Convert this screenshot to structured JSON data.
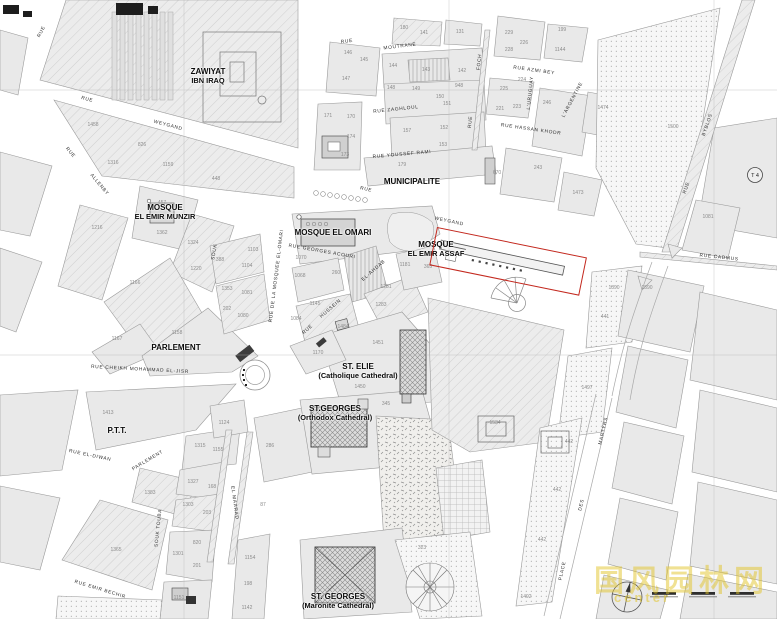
{
  "map": {
    "highlight_color": "#c3281e",
    "t4_label": "T 4",
    "watermark": {
      "line1": "国风园林网",
      "line2": "center"
    },
    "landmarks": [
      {
        "line1": "ZAWIYAT",
        "line2": "IBN IRAQ",
        "x": 208,
        "y": 76
      },
      {
        "line1": "MOSQUE",
        "line2": "EL EMIR MUNZIR",
        "x": 165,
        "y": 212
      },
      {
        "line1": "MOSQUE EL OMARI",
        "x": 333,
        "y": 233
      },
      {
        "line1": "MUNICIPALITE",
        "x": 412,
        "y": 182
      },
      {
        "line1": "MOSQUE",
        "line2": "EL EMIR ASSAF",
        "x": 436,
        "y": 249
      },
      {
        "line1": "PARLEMENT",
        "x": 176,
        "y": 348
      },
      {
        "line1": "ST. ELIE",
        "line2": "(Catholique Cathedral)",
        "x": 358,
        "y": 371
      },
      {
        "line1": "ST.GEORGES",
        "line2": "(Orthodox Cathedral)",
        "x": 335,
        "y": 413
      },
      {
        "line1": "P.T.T.",
        "x": 117,
        "y": 431
      },
      {
        "line1": "ST. GEORGES",
        "line2": "(Maronite Cathedral)",
        "x": 338,
        "y": 601
      }
    ],
    "streets": [
      {
        "t": "RUE",
        "x": 42,
        "y": 32,
        "r": -62
      },
      {
        "t": "RUE",
        "x": 87,
        "y": 100,
        "r": 15
      },
      {
        "t": "WEYGAND",
        "x": 168,
        "y": 126,
        "r": 15
      },
      {
        "t": "RUE",
        "x": 366,
        "y": 190,
        "r": 13
      },
      {
        "t": "WEYGAND",
        "x": 449,
        "y": 222,
        "r": 12
      },
      {
        "t": "RUE",
        "x": 70,
        "y": 153,
        "r": 50
      },
      {
        "t": "ALLENBY",
        "x": 99,
        "y": 185,
        "r": 50
      },
      {
        "t": "RUE",
        "x": 347,
        "y": 42,
        "r": -7
      },
      {
        "t": "MOUTRANE",
        "x": 400,
        "y": 47,
        "r": -7
      },
      {
        "t": "RUE ZAGHLOUL",
        "x": 396,
        "y": 110,
        "r": -6
      },
      {
        "t": "RUE YOUSSEF RAMI",
        "x": 402,
        "y": 155,
        "r": -5
      },
      {
        "t": "FOCH",
        "x": 480,
        "y": 62,
        "r": -84
      },
      {
        "t": "RUE",
        "x": 471,
        "y": 122,
        "r": -84
      },
      {
        "t": "RUE AZMI BEY",
        "x": 534,
        "y": 71,
        "r": 8
      },
      {
        "t": "L'URUGUAY",
        "x": 531,
        "y": 93,
        "r": -84
      },
      {
        "t": "L'ARGENTINE",
        "x": 573,
        "y": 100,
        "r": -62
      },
      {
        "t": "RUE HASSAN KHODR",
        "x": 531,
        "y": 130,
        "r": 8
      },
      {
        "t": "BYBLOS",
        "x": 708,
        "y": 125,
        "r": -71
      },
      {
        "t": "RUE",
        "x": 687,
        "y": 188,
        "r": -71
      },
      {
        "t": "RUE CADMUS",
        "x": 719,
        "y": 258,
        "r": 6
      },
      {
        "t": "RUE GEORGES ACOURI",
        "x": 322,
        "y": 252,
        "r": 10
      },
      {
        "t": "RUE DE LA MOSQUEE EL-OMARI",
        "x": 277,
        "y": 276,
        "r": -83
      },
      {
        "t": "EL-AHDAB",
        "x": 374,
        "y": 271,
        "r": -41
      },
      {
        "t": "HUSSEIN",
        "x": 331,
        "y": 309,
        "r": -41
      },
      {
        "t": "RUE",
        "x": 308,
        "y": 330,
        "r": -41
      },
      {
        "t": "SOUK",
        "x": 215,
        "y": 252,
        "r": -80
      },
      {
        "t": "RUE CHEIKH MOHAMMAD EL-JISR",
        "x": 140,
        "y": 370,
        "r": 3
      },
      {
        "t": "PARLEMENT",
        "x": 148,
        "y": 461,
        "r": -31
      },
      {
        "t": "RUE EL-DIWAN",
        "x": 90,
        "y": 456,
        "r": 12
      },
      {
        "t": "SOUK TOUBA",
        "x": 159,
        "y": 528,
        "r": -84
      },
      {
        "t": "EL MAARAD",
        "x": 234,
        "y": 503,
        "r": 82
      },
      {
        "t": "RUE EMIR BECHIR",
        "x": 100,
        "y": 590,
        "r": 17
      },
      {
        "t": "MARTYRS",
        "x": 604,
        "y": 431,
        "r": -77
      },
      {
        "t": "DES",
        "x": 582,
        "y": 505,
        "r": -77
      },
      {
        "t": "PLACE",
        "x": 563,
        "y": 571,
        "r": -77
      }
    ],
    "parcels": [
      {
        "n": "1458",
        "x": 93,
        "y": 125
      },
      {
        "n": "826",
        "x": 142,
        "y": 145
      },
      {
        "n": "1316",
        "x": 113,
        "y": 163
      },
      {
        "n": "1159",
        "x": 168,
        "y": 165
      },
      {
        "n": "448",
        "x": 216,
        "y": 179
      },
      {
        "n": "146",
        "x": 348,
        "y": 53
      },
      {
        "n": "145",
        "x": 364,
        "y": 60
      },
      {
        "n": "147",
        "x": 346,
        "y": 79
      },
      {
        "n": "180",
        "x": 404,
        "y": 28
      },
      {
        "n": "141",
        "x": 424,
        "y": 33
      },
      {
        "n": "131",
        "x": 460,
        "y": 32
      },
      {
        "n": "144",
        "x": 393,
        "y": 66
      },
      {
        "n": "143",
        "x": 426,
        "y": 70
      },
      {
        "n": "142",
        "x": 462,
        "y": 71
      },
      {
        "n": "148",
        "x": 391,
        "y": 88
      },
      {
        "n": "149",
        "x": 416,
        "y": 89
      },
      {
        "n": "948",
        "x": 459,
        "y": 86
      },
      {
        "n": "150",
        "x": 440,
        "y": 97
      },
      {
        "n": "151",
        "x": 447,
        "y": 104
      },
      {
        "n": "171",
        "x": 328,
        "y": 116
      },
      {
        "n": "170",
        "x": 351,
        "y": 117
      },
      {
        "n": "174",
        "x": 351,
        "y": 137
      },
      {
        "n": "173",
        "x": 345,
        "y": 155
      },
      {
        "n": "157",
        "x": 407,
        "y": 131
      },
      {
        "n": "152",
        "x": 444,
        "y": 128
      },
      {
        "n": "153",
        "x": 443,
        "y": 145
      },
      {
        "n": "179",
        "x": 402,
        "y": 165
      },
      {
        "n": "670",
        "x": 497,
        "y": 173
      },
      {
        "n": "229",
        "x": 509,
        "y": 33
      },
      {
        "n": "228",
        "x": 509,
        "y": 50
      },
      {
        "n": "226",
        "x": 524,
        "y": 43
      },
      {
        "n": "199",
        "x": 562,
        "y": 30
      },
      {
        "n": "1144",
        "x": 560,
        "y": 50
      },
      {
        "n": "225",
        "x": 504,
        "y": 89
      },
      {
        "n": "224",
        "x": 522,
        "y": 80
      },
      {
        "n": "221",
        "x": 500,
        "y": 109
      },
      {
        "n": "223",
        "x": 517,
        "y": 107
      },
      {
        "n": "246",
        "x": 547,
        "y": 103
      },
      {
        "n": "243",
        "x": 538,
        "y": 168
      },
      {
        "n": "1473",
        "x": 578,
        "y": 193
      },
      {
        "n": "1474",
        "x": 603,
        "y": 108
      },
      {
        "n": "1500",
        "x": 673,
        "y": 127
      },
      {
        "n": "1081",
        "x": 708,
        "y": 217
      },
      {
        "n": "1590",
        "x": 647,
        "y": 288
      },
      {
        "n": "457",
        "x": 162,
        "y": 203
      },
      {
        "n": "1362",
        "x": 162,
        "y": 233
      },
      {
        "n": "1324",
        "x": 193,
        "y": 243
      },
      {
        "n": "1220",
        "x": 196,
        "y": 269
      },
      {
        "n": "1216",
        "x": 97,
        "y": 228
      },
      {
        "n": "1166",
        "x": 135,
        "y": 283
      },
      {
        "n": "1167",
        "x": 117,
        "y": 339
      },
      {
        "n": "1158",
        "x": 177,
        "y": 333
      },
      {
        "n": "1353",
        "x": 227,
        "y": 289
      },
      {
        "n": "202",
        "x": 227,
        "y": 309
      },
      {
        "n": "1080",
        "x": 243,
        "y": 316
      },
      {
        "n": "388",
        "x": 220,
        "y": 260
      },
      {
        "n": "1104",
        "x": 247,
        "y": 266
      },
      {
        "n": "1103",
        "x": 253,
        "y": 250
      },
      {
        "n": "1081",
        "x": 247,
        "y": 293
      },
      {
        "n": "1070",
        "x": 301,
        "y": 258
      },
      {
        "n": "1068",
        "x": 300,
        "y": 276
      },
      {
        "n": "260",
        "x": 336,
        "y": 273
      },
      {
        "n": "1145",
        "x": 315,
        "y": 304
      },
      {
        "n": "1084",
        "x": 296,
        "y": 319
      },
      {
        "n": "1281",
        "x": 386,
        "y": 287
      },
      {
        "n": "1283",
        "x": 381,
        "y": 305
      },
      {
        "n": "1484",
        "x": 343,
        "y": 327
      },
      {
        "n": "1451",
        "x": 378,
        "y": 343
      },
      {
        "n": "1170",
        "x": 318,
        "y": 353
      },
      {
        "n": "1450",
        "x": 360,
        "y": 387
      },
      {
        "n": "1181",
        "x": 405,
        "y": 265
      },
      {
        "n": "365",
        "x": 428,
        "y": 267
      },
      {
        "n": "1890",
        "x": 614,
        "y": 288
      },
      {
        "n": "441",
        "x": 605,
        "y": 317
      },
      {
        "n": "1497",
        "x": 587,
        "y": 388
      },
      {
        "n": "1413",
        "x": 108,
        "y": 413
      },
      {
        "n": "1383",
        "x": 150,
        "y": 493
      },
      {
        "n": "1365",
        "x": 116,
        "y": 550
      },
      {
        "n": "1327",
        "x": 193,
        "y": 482
      },
      {
        "n": "168",
        "x": 212,
        "y": 487
      },
      {
        "n": "1303",
        "x": 188,
        "y": 505
      },
      {
        "n": "203",
        "x": 207,
        "y": 513
      },
      {
        "n": "820",
        "x": 197,
        "y": 543
      },
      {
        "n": "1301",
        "x": 178,
        "y": 554
      },
      {
        "n": "201",
        "x": 197,
        "y": 566
      },
      {
        "n": "1151",
        "x": 179,
        "y": 598
      },
      {
        "n": "1124",
        "x": 224,
        "y": 423
      },
      {
        "n": "1315",
        "x": 200,
        "y": 446
      },
      {
        "n": "1155",
        "x": 218,
        "y": 450
      },
      {
        "n": "1154",
        "x": 250,
        "y": 558
      },
      {
        "n": "198",
        "x": 248,
        "y": 584
      },
      {
        "n": "1142",
        "x": 247,
        "y": 608
      },
      {
        "n": "286",
        "x": 270,
        "y": 446
      },
      {
        "n": "345",
        "x": 386,
        "y": 404
      },
      {
        "n": "1534",
        "x": 495,
        "y": 423
      },
      {
        "n": "323",
        "x": 422,
        "y": 548
      },
      {
        "n": "87",
        "x": 263,
        "y": 505
      },
      {
        "n": "442",
        "x": 569,
        "y": 442
      },
      {
        "n": "442",
        "x": 557,
        "y": 490
      },
      {
        "n": "442",
        "x": 542,
        "y": 540
      },
      {
        "n": "1492",
        "x": 526,
        "y": 597
      }
    ]
  }
}
